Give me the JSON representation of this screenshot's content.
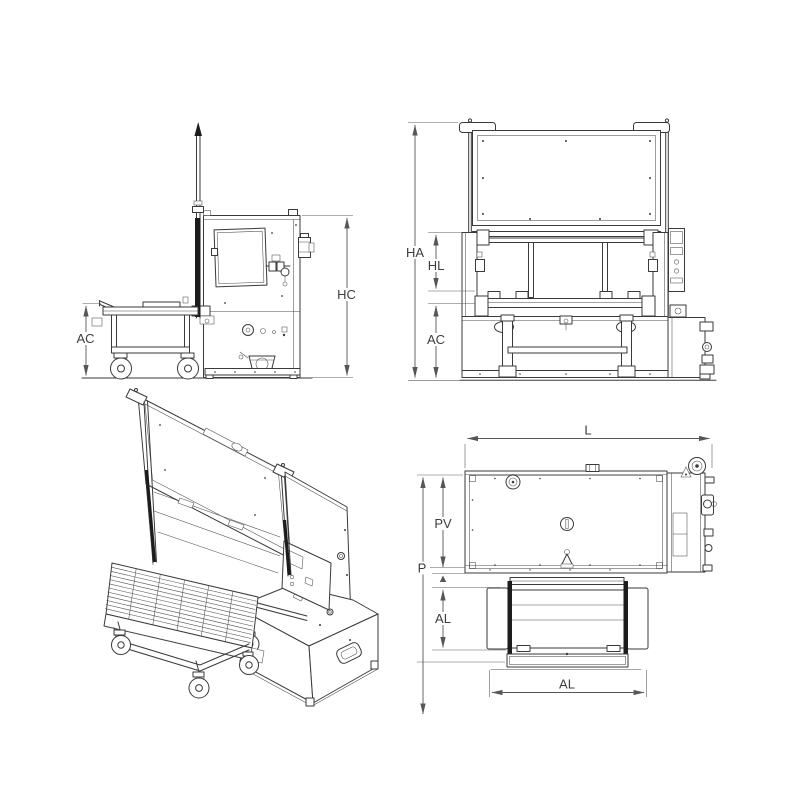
{
  "views": {
    "side": {
      "dims": {
        "hc": "HC",
        "ac": "AC"
      }
    },
    "front": {
      "dims": {
        "ha": "HA",
        "hl": "HL",
        "ac": "AC"
      }
    },
    "top": {
      "dims": {
        "l": "L",
        "p": "P",
        "pv": "PV",
        "al_depth": "AL",
        "al_width": "AL"
      }
    }
  },
  "colors": {
    "background": "#ffffff",
    "line": "#3a3a3a",
    "dim_line": "#565656",
    "text": "#3d3d3d",
    "dark_fill": "#1c1c1c"
  }
}
